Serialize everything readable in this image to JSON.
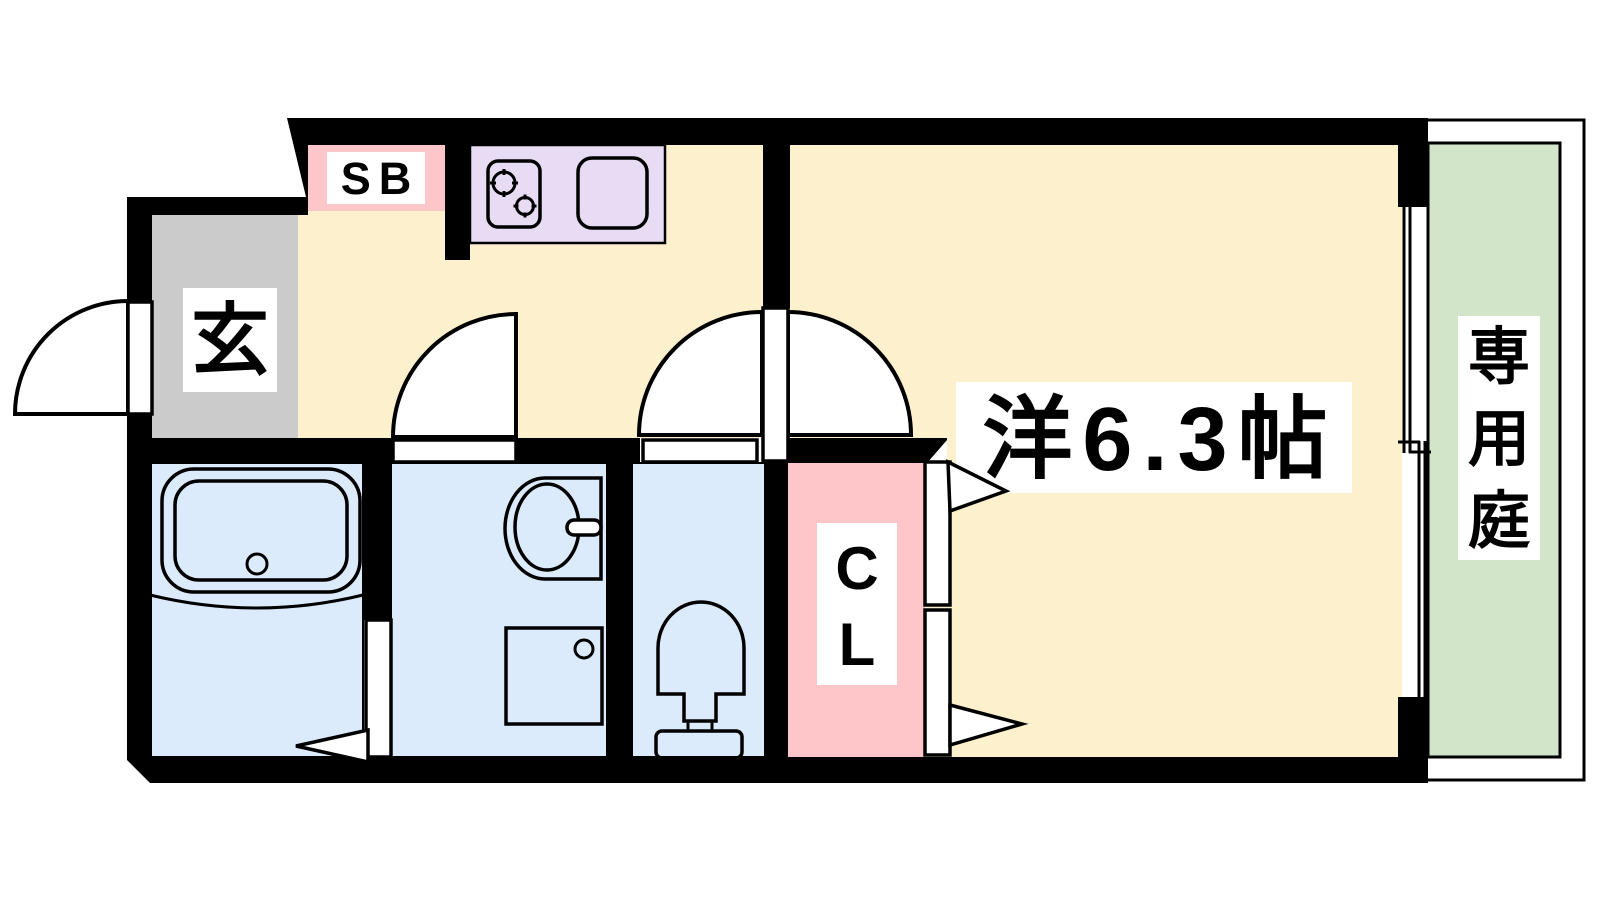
{
  "page": {
    "type": "floor-plan",
    "background": "#ffffff"
  },
  "colors": {
    "wall": "#000000",
    "line": "#000000",
    "floor_main": "#fdf0cd",
    "floor_entrance": "#cbcbcb",
    "floor_wet": "#dcebfc",
    "accent_pink": "#ffc6c9",
    "accent_lavender": "#e7dcf4",
    "garden_green": "#d2e5c9",
    "label_bg": "#ffffff"
  },
  "labels": {
    "entrance": "玄",
    "shoe_box": "SB",
    "closet": "CL",
    "closet_chars": [
      "C",
      "L"
    ],
    "main_room": "洋6.3帖",
    "garden": "専用庭",
    "garden_chars": [
      "専",
      "用",
      "庭"
    ]
  },
  "rooms": [
    {
      "name": "entrance",
      "label": "玄"
    },
    {
      "name": "shoe-box",
      "label": "SB"
    },
    {
      "name": "kitchen-hallway",
      "label": ""
    },
    {
      "name": "bathroom",
      "label": ""
    },
    {
      "name": "washroom",
      "label": ""
    },
    {
      "name": "toilet-room",
      "label": ""
    },
    {
      "name": "closet",
      "label": "CL"
    },
    {
      "name": "western-room",
      "label": "洋6.3帖",
      "size_tatami": 6.3
    },
    {
      "name": "private-garden",
      "label": "専用庭"
    }
  ],
  "fixtures": [
    "bathtub-icon",
    "wash-basin-icon",
    "faucet-icon",
    "washing-machine-pan-icon",
    "toilet-icon",
    "gas-stove-icon",
    "kitchen-sink-icon",
    "sliding-window-icon",
    "swing-door-icon",
    "folding-door-icon"
  ]
}
